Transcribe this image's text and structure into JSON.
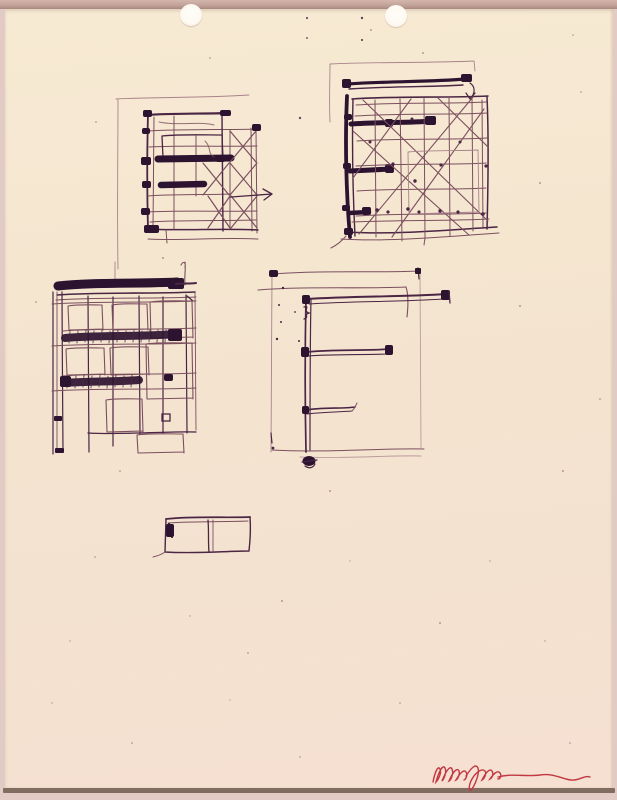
{
  "artwork": {
    "alt": "Pen-and-ink architectural study sketches on a cream sheet with two punched holes, signed in red ink at lower right",
    "medium": "ink sketch on paper",
    "colors": {
      "mat": "#e2cbc5",
      "mat-top": "#b99a90",
      "paper": "#f4e5d0",
      "paper-edge": "#6b5848",
      "ink-heavy": "#2c1330",
      "ink": "#4a2544",
      "ink-light": "#7b4f5e",
      "ink-faint": "#a8838a",
      "signature-red": "#c23842"
    },
    "sketches": [
      {
        "id": "facade-grid-arrow",
        "label": "Square facade grid with heavy dark bands, cross bracing and a right-pointing arrow"
      },
      {
        "id": "facade-grid-diagonals",
        "label": "Square facade grid with long crossing diagonals and three heavy bars on the left edge"
      },
      {
        "id": "elevation-cornice",
        "label": "Building elevation with dark cornice band, window grid and two hatched floor bands"
      },
      {
        "id": "e-shaped-plan",
        "label": "E-shaped figure with vertical spine and three arms inside a light rectangular outline"
      },
      {
        "id": "two-cell-rectangle",
        "label": "Small two-cell rectangle with a dark mark in its upper-left corner"
      }
    ],
    "holes": {
      "count": 2,
      "label": "two punched holes at top of sheet"
    },
    "signature": {
      "label": "artist signature in red ink, illegible cursive with long trailing flourish",
      "legible": false
    }
  }
}
